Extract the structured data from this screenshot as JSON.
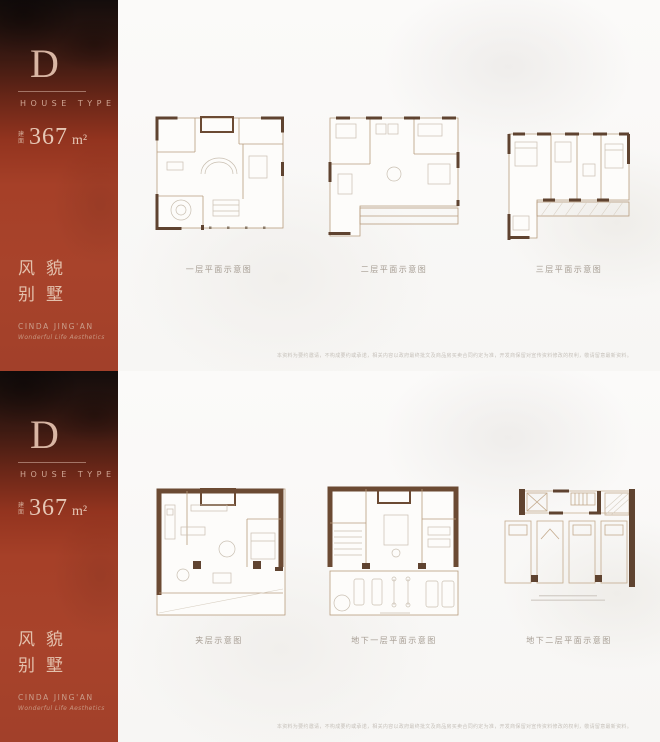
{
  "panels": [
    {
      "sidebar": {
        "letter": "D",
        "subtitle": "HOUSE TYPE",
        "area_prefix": "建面",
        "area_value": "367",
        "area_unit": "m²",
        "name_line1": "风貌",
        "name_line2": "别墅",
        "brand": "CINDA JING'AN",
        "tagline": "Wonderful Life Aesthetics"
      },
      "plans": [
        {
          "caption": "一层平面示意图"
        },
        {
          "caption": "二层平面示意图"
        },
        {
          "caption": "三层平面示意图"
        }
      ],
      "disclaimer": "本资料为要约邀请，不构成要约或承诺，相关内容以政府最终批文及商品房买卖合同约定为准，开发商保留对宣传资料修改的权利，敬请留意最新资料。"
    },
    {
      "sidebar": {
        "letter": "D",
        "subtitle": "HOUSE TYPE",
        "area_prefix": "建面",
        "area_value": "367",
        "area_unit": "m²",
        "name_line1": "风貌",
        "name_line2": "别墅",
        "brand": "CINDA JING'AN",
        "tagline": "Wonderful Life Aesthetics"
      },
      "plans": [
        {
          "caption": "夹层示意图"
        },
        {
          "caption": "地下一层平面示意图"
        },
        {
          "caption": "地下二层平面示意图"
        }
      ],
      "disclaimer": "本资料为要约邀请，不构成要约或承诺，相关内容以政府最终批文及商品房买卖合同约定为准，开发商保留对宣传资料修改的权利，敬请留意最新资料。"
    }
  ],
  "colors": {
    "sidebar_red": "#a8432b",
    "sidebar_dark": "#140d0c",
    "pale_text": "#d9b6a4",
    "wall_dark": "#5f4330",
    "wall_light": "#b79c7e",
    "caption_text": "#a59c92"
  }
}
